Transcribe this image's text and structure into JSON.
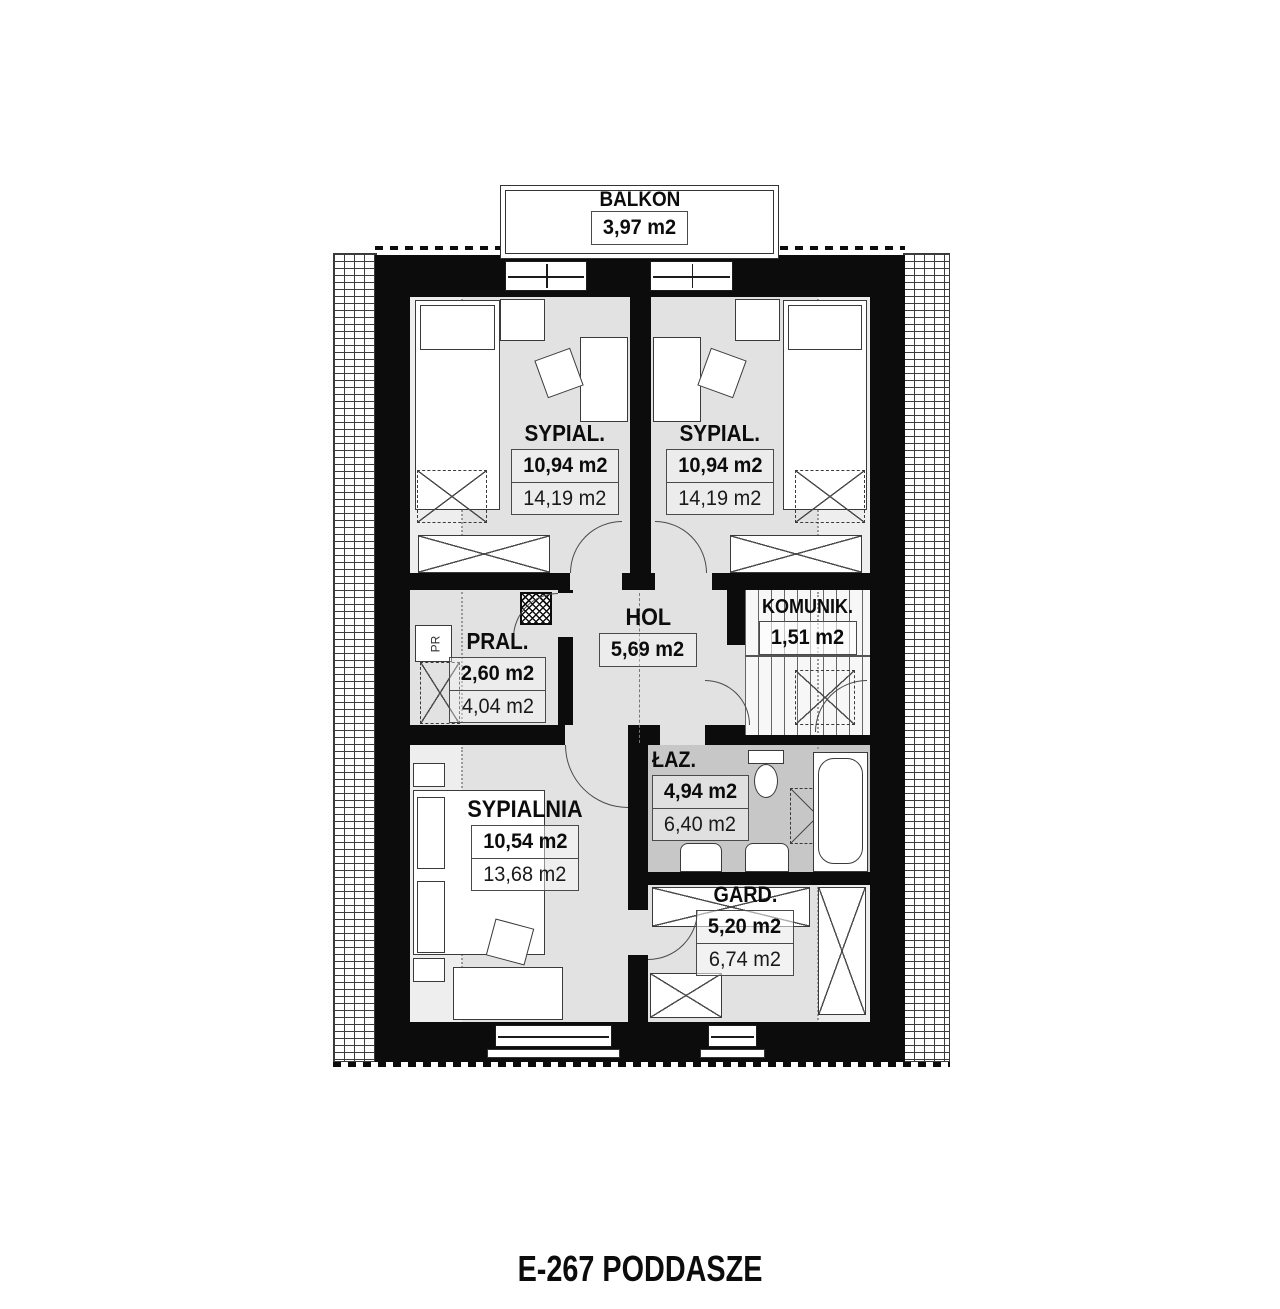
{
  "title": "E-267 PODDASZE",
  "balcony": {
    "name": "BALKON",
    "area": "3,97 m2"
  },
  "rooms": {
    "sypial_left": {
      "name": "SYPIAL.",
      "usable_area": "10,94 m2",
      "floor_area": "14,19 m2"
    },
    "sypial_right": {
      "name": "SYPIAL.",
      "usable_area": "10,94 m2",
      "floor_area": "14,19 m2"
    },
    "komunik": {
      "name": "KOMUNIK.",
      "usable_area": "1,51 m2"
    },
    "pral": {
      "name": "PRAL.",
      "usable_area": "2,60 m2",
      "floor_area": "4,04 m2"
    },
    "hol": {
      "name": "HOL",
      "usable_area": "5,69 m2"
    },
    "laz": {
      "name": "ŁAZ.",
      "usable_area": "4,94 m2",
      "floor_area": "6,40 m2"
    },
    "sypialnia": {
      "name": "SYPIALNIA",
      "usable_area": "10,54 m2",
      "floor_area": "13,68 m2"
    },
    "gard": {
      "name": "GARD.",
      "usable_area": "5,20 m2",
      "floor_area": "6,74 m2"
    }
  },
  "appliances": {
    "washer": "PR"
  },
  "colors": {
    "wall": "#0c0c0c",
    "floor": "#e2e2e2",
    "bath_floor": "#c7c7c7",
    "line": "#4a4a4a"
  }
}
